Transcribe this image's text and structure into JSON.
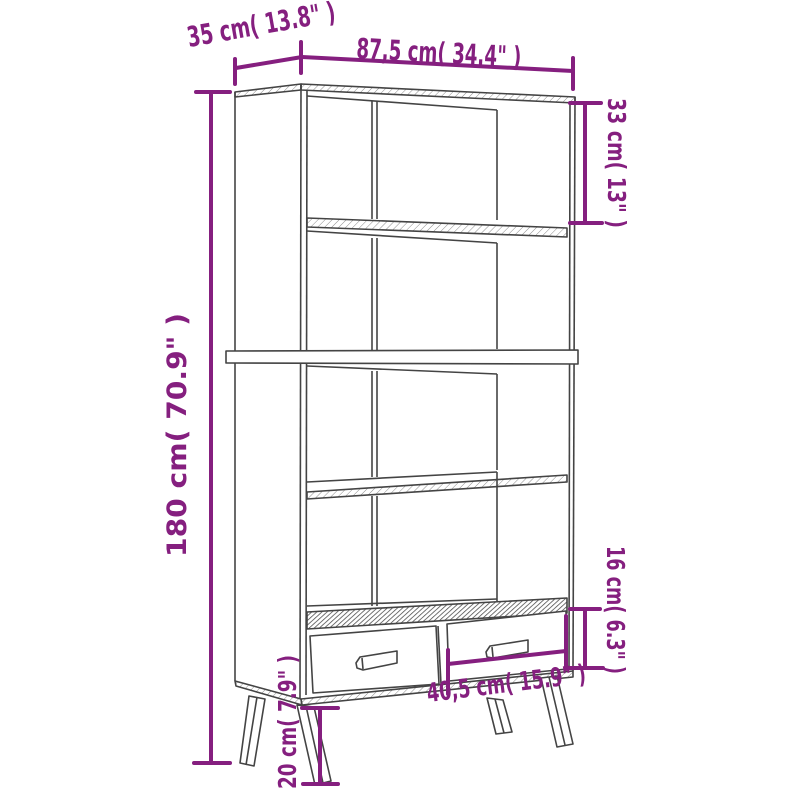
{
  "diagram": {
    "type": "furniture-dimension-drawing",
    "colors": {
      "dimension_accent": "#851f7f",
      "drawing_line": "#444444",
      "background": "#ffffff"
    },
    "labels": {
      "width": "87,5 cm( 34.4\" )",
      "depth": "35 cm( 13.8\" )",
      "height": "180 cm( 70.9\" )",
      "top_compartment_height": "33 cm( 13\" )",
      "drawer_height": "16 cm( 6.3\" )",
      "drawer_width": "40,5 cm( 15.9\" )",
      "leg_height": "20 cm( 7.9\" )"
    }
  }
}
